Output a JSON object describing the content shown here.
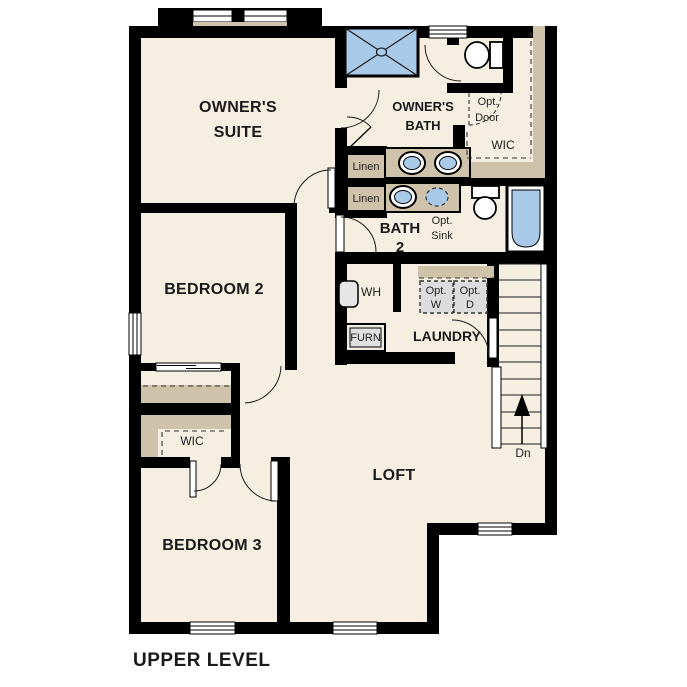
{
  "plan_title": "UPPER LEVEL",
  "level": "upper",
  "colors": {
    "floor": "#f5eee1",
    "wall": "#000000",
    "shelf_tan": "#cec2ab",
    "fixture_blue": "#a9c9e9",
    "appliance_gray": "#dcdcdc",
    "background": "#ffffff"
  },
  "rooms": {
    "owners_suite": {
      "line1": "OWNER'S",
      "line2": "SUITE"
    },
    "owners_bath": {
      "line1": "OWNER'S",
      "line2": "BATH"
    },
    "bath2": {
      "line1": "BATH",
      "line2": "2"
    },
    "bedroom2": {
      "label": "BEDROOM 2"
    },
    "bedroom3": {
      "label": "BEDROOM 3"
    },
    "laundry": {
      "label": "LAUNDRY"
    },
    "loft": {
      "label": "LOFT"
    },
    "wic_owners": {
      "label": "WIC"
    },
    "wic_bedroom3": {
      "label": "WIC"
    }
  },
  "fixtures": {
    "linen1": {
      "label": "Linen"
    },
    "linen2": {
      "label": "Linen"
    },
    "water_heater": {
      "label": "WH"
    },
    "furnace": {
      "label": "FURN"
    },
    "opt_washer": {
      "line1": "Opt.",
      "line2": "W"
    },
    "opt_dryer": {
      "line1": "Opt.",
      "line2": "D"
    },
    "opt_sink": {
      "line1": "Opt.",
      "line2": "Sink"
    },
    "opt_door": {
      "line1": "Opt.",
      "line2": "Door"
    },
    "stairs": {
      "direction_label": "Dn"
    }
  }
}
